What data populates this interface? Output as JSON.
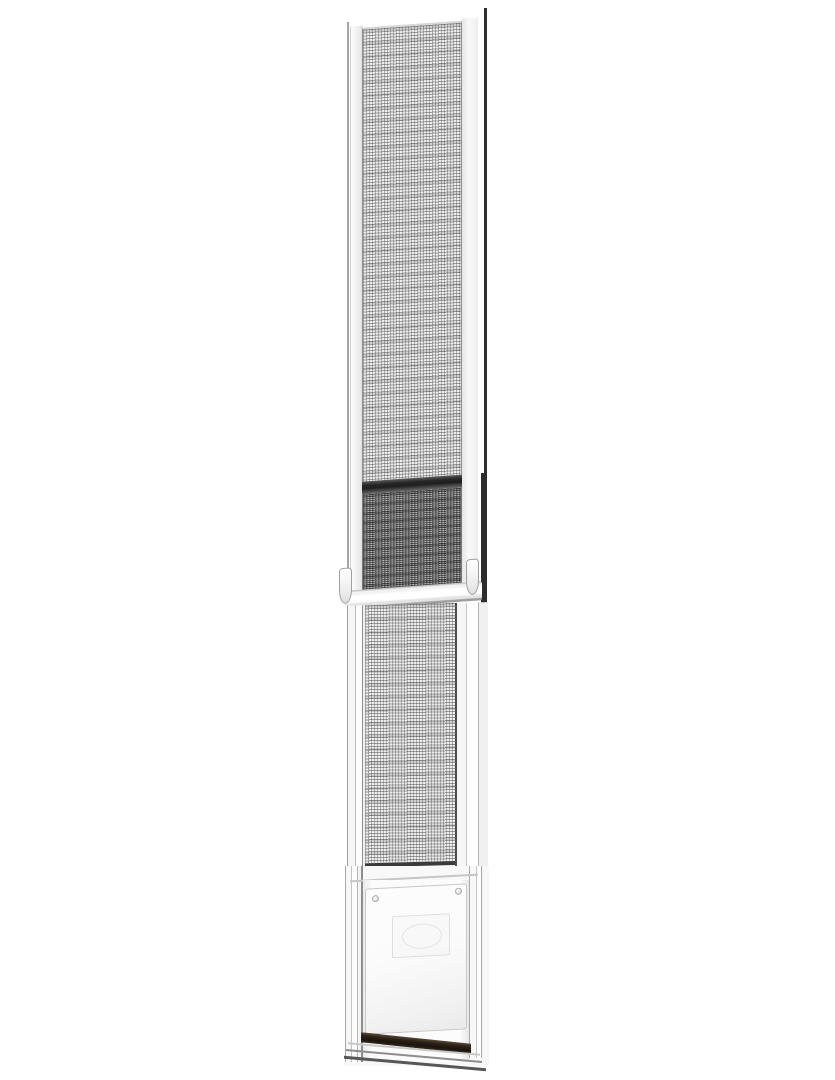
{
  "scene": {
    "description": "Product photo on a plain white background: a tall white aluminum sliding patio door pet panel insert, with an adjustable-height screen mesh extension on top, a spring-latch slide rail in the middle, a fixed lower screen panel, and a white pet flap door with an embossed logo badge and a dark magnetic weather strip at the bottom.",
    "background_color": "#ffffff"
  },
  "colors": {
    "bg": "#ffffff",
    "rail_left": "#a6a6a6",
    "rail_right": "#2d2d2d",
    "frame_white": "#f8f8f8",
    "frame_line": "#9c9c9c",
    "mesh_base": "#ececec",
    "mesh_overlap_base": "#b4b4b4",
    "divider_bar": "#262626",
    "flap_white": "#fdfdfd",
    "magnet_dark": "#1b140e",
    "magnet_light": "#594736",
    "screw": "#c9c9c9"
  },
  "parts": {
    "upper_screen_panel": "adjustable upper screen extension",
    "overlap_section": "doubled screen overlap area",
    "slide_rail": "white slide-lock rail with two latch clips",
    "lower_screen_panel": "fixed lower screen panel",
    "pet_flap_frame": "pet door frame",
    "pet_flap": "white pet flap with embossed logo badge",
    "magnetic_strip": "dark magnetic weather strip"
  }
}
